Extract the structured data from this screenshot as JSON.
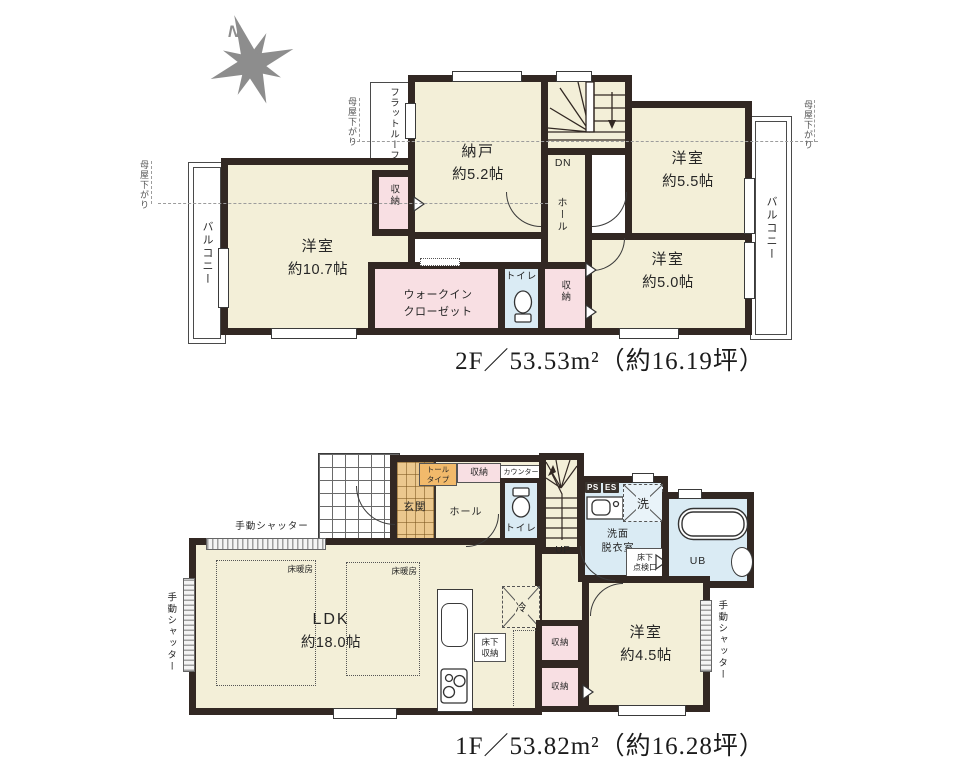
{
  "compass": {
    "label": "N"
  },
  "colors": {
    "wall": "#322823",
    "room_fill": "#f3efd8",
    "closet_fill": "#f8dfe3",
    "wet_area_fill": "#daebf4",
    "genkan_fill": "#ebc88e",
    "cabinet_label_fill": "#f2ba6b",
    "caption_text": "#1b1b1b",
    "compass_gray": "#8d8d8d"
  },
  "floor2": {
    "caption": "2F／53.53m²（約16.19坪）",
    "rooms": {
      "nando": {
        "name": "納戸",
        "size": "約5.2帖"
      },
      "yoshitsu_55": {
        "name": "洋室",
        "size": "約5.5帖"
      },
      "yoshitsu_107": {
        "name": "洋室",
        "size": "約10.7帖"
      },
      "yoshitsu_50": {
        "name": "洋室",
        "size": "約5.0帖"
      },
      "wic": {
        "name": "ウォークイン\nクローゼット"
      },
      "toilet": {
        "name": "トイレ"
      },
      "hall": {
        "name": "ホール"
      },
      "closet_upper": {
        "name": "収納"
      },
      "closet_lower": {
        "name": "収納"
      }
    },
    "labels": {
      "dn": "DN",
      "flat_roof": "フラットルーフ",
      "moya_sagari": "母屋下がり",
      "balcony": "バルコニー"
    }
  },
  "floor1": {
    "caption": "1F／53.82m²（約16.28坪）",
    "rooms": {
      "ldk": {
        "name": "LDK",
        "size": "約18.0帖"
      },
      "yoshitsu_45": {
        "name": "洋室",
        "size": "約4.5帖"
      },
      "genkan": {
        "name": "玄関"
      },
      "hall": {
        "name": "ホール"
      },
      "toilet": {
        "name": "トイレ"
      },
      "senmen": {
        "name": "洗面\n脱衣室"
      },
      "ub": {
        "name": "UB"
      },
      "closet_entry": {
        "name": "収納"
      },
      "closet_a": {
        "name": "収納"
      },
      "closet_b": {
        "name": "収納"
      }
    },
    "labels": {
      "up": "UP",
      "counter": "カウンター",
      "tall_type": "トール\nタイプ",
      "ps": "PS",
      "es": "ES",
      "washer": "洗",
      "refrigerator": "冷",
      "underfloor_hatch": "床下\n点検口",
      "underfloor_storage": "床下\n収納",
      "floor_heating": "床暖房",
      "manual_shutter": "手動シャッター"
    }
  }
}
